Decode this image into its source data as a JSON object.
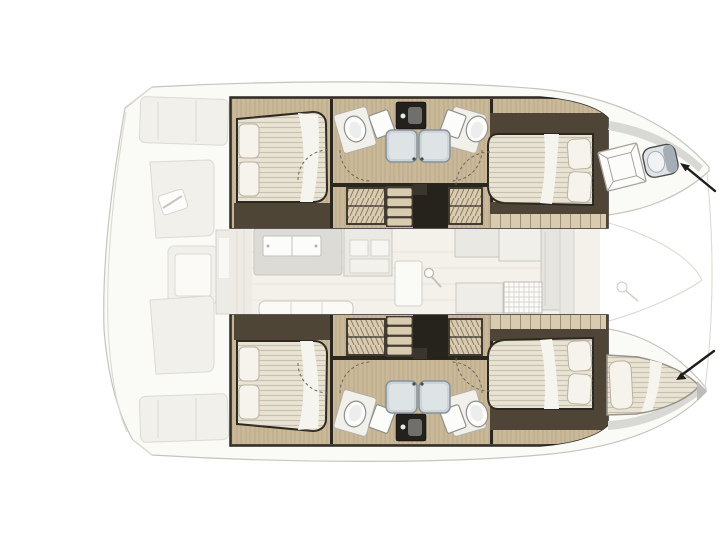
{
  "diagram": {
    "kind": "catamaran-floor-plan",
    "orientation": "bow-right"
  },
  "colors": {
    "background": "#ffffff",
    "outline": "#c7c4be",
    "outline_soft": "#dddad4",
    "deck": "#fafaf7",
    "deck_panel": "#f2f0ea",
    "wall": "#4e4537",
    "wall_dark": "#2a2620",
    "wood": "#c9b999",
    "wood_light": "#d8cbb0",
    "mattress": "#e9e3d4",
    "pillow": "#f6f3ec",
    "pillow_stroke": "#bab3a2",
    "bed_outline": "#2b2721",
    "shower": "#ccd4d9",
    "shower_stroke": "#87929a",
    "fixture_white": "#fcfcfa",
    "fixture_stroke": "#8f8f8d",
    "toilet_body": "#dfe3e7",
    "toilet_lid": "#a5aeb6",
    "salon_floor": "#f3f1ea",
    "salon_furniture": "#dddbd5",
    "salon_white": "#fcfcfa",
    "salon_stroke": "#c9c6bf",
    "arrow": "#1d1d1b"
  },
  "features": {
    "hulls": [
      {
        "name": "port-hull",
        "cabins": [
          "aft-double-cabin",
          "forward-double-cabin"
        ],
        "bathroom": {
          "showers": 2,
          "sinks": 2,
          "vanity": 1
        },
        "bow_feature": "crew-toilet"
      },
      {
        "name": "starboard-hull",
        "cabins": [
          "aft-double-cabin",
          "forward-double-cabin"
        ],
        "bathroom": {
          "showers": 2,
          "sinks": 2,
          "vanity": 1
        },
        "bow_feature": "crew-berth"
      }
    ],
    "salon": [
      "dinette-table",
      "cabinet",
      "door",
      "galley-counters",
      "stove",
      "refrigerator",
      "sofa"
    ],
    "stern": [
      "cockpit-benches",
      "cockpit-table",
      "sliding-door"
    ],
    "foredeck": [
      "trampoline",
      "mast-foot",
      "deck-hatch"
    ],
    "annotations": [
      "arrow-to-bow-toilet",
      "arrow-to-bow-berth"
    ]
  }
}
